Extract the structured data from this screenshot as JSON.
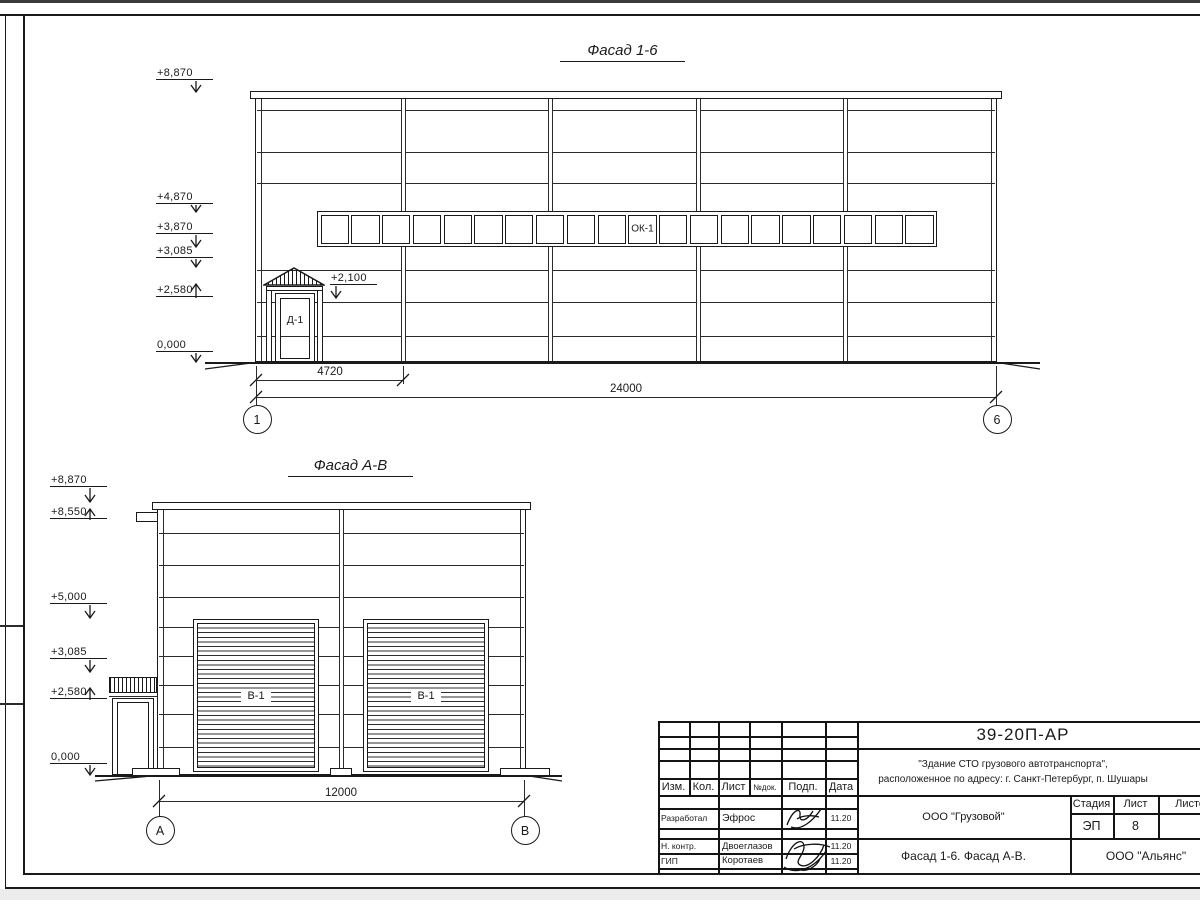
{
  "facade1": {
    "title": "Фасад 1-6",
    "marks": {
      "m8870": "+8,870",
      "m4870": "+4,870",
      "m3870": "+3,870",
      "m3085": "+3,085",
      "m2580": "+2,580",
      "m0": "0,000",
      "door": "+2,100"
    },
    "window": {
      "label": "ОК-1",
      "panes": 20
    },
    "door_label": "Д-1",
    "dims": {
      "bay": "4720",
      "total": "24000"
    },
    "axes": {
      "left": "1",
      "right": "6"
    }
  },
  "facade2": {
    "title": "Фасад А-В",
    "marks": {
      "m8870": "+8,870",
      "m8550": "+8,550",
      "m5000": "+5,000",
      "m3085": "+3,085",
      "m2580": "+2,580",
      "m0": "0,000"
    },
    "gate_label": "В-1",
    "dims": {
      "total": "12000"
    },
    "axes": {
      "left": "А",
      "right": "В"
    }
  },
  "titleblock": {
    "doc_code": "39-20П-АР",
    "project_line1": "\"Здание СТО грузового автотранспорта\",",
    "project_line2": "расположенное по адресу: г. Санкт-Петербург, п. Шушары",
    "rev_headers": {
      "izm": "Изм.",
      "kol": "Кол.",
      "list": "Лист",
      "ndok": "№док.",
      "podp": "Подп.",
      "data": "Дата"
    },
    "signers": [
      {
        "role": "Разработал",
        "name": "Эфрос",
        "date": "11.20"
      },
      {
        "role": "Н. контр.",
        "name": "Двоеглазов",
        "date": "11.20"
      },
      {
        "role": "ГИП",
        "name": "Коротаев",
        "date": "11.20"
      }
    ],
    "client": "ООО \"Грузовой\"",
    "stage_header": "Стадия",
    "list_header": "Лист",
    "listov_header": "Листов",
    "stage": "ЭП",
    "sheet_no": "8",
    "sheets_total": "",
    "sheet_title": "Фасад 1-6. Фасад А-В.",
    "company": "ООО \"Альянс\""
  }
}
